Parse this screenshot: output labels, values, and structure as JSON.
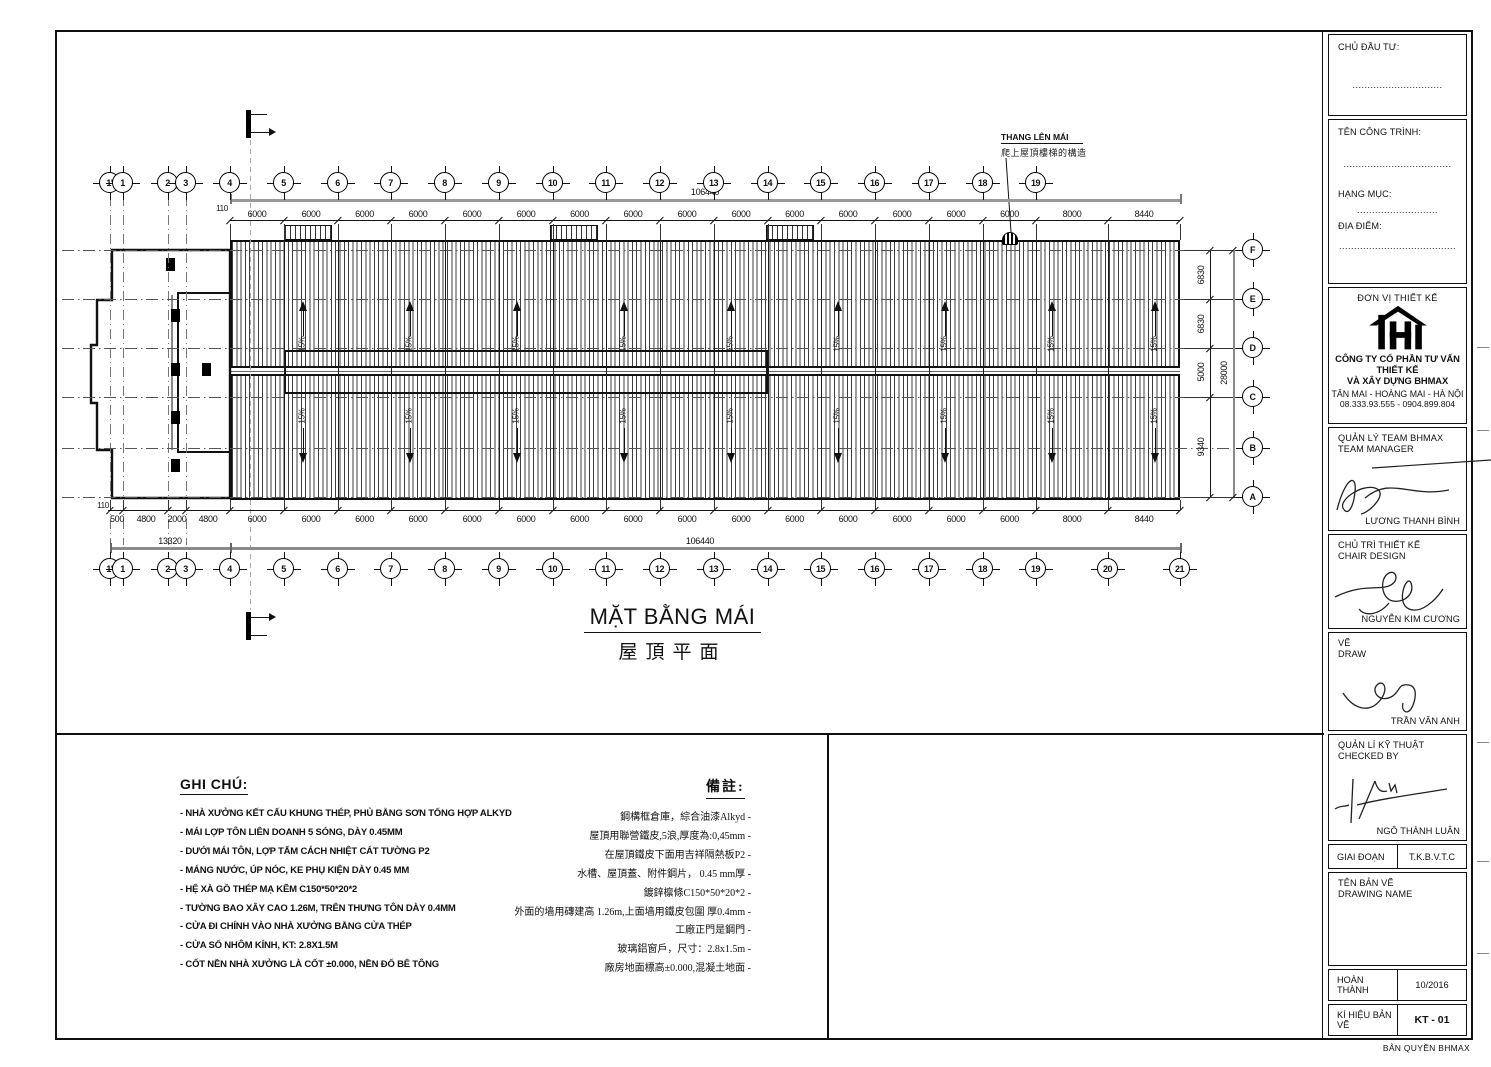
{
  "plan": {
    "title_vi": "MẶT BẰNG MÁI",
    "title_cn": "屋頂平面",
    "ladder_label_vi": "THANG LÊN MÁI",
    "ladder_label_cn": "爬上屋頂樓梯的構造",
    "slope_label": "15%",
    "grids": {
      "top": [
        "1'",
        "1",
        "2",
        "3",
        "4",
        "5",
        "6",
        "7",
        "8",
        "9",
        "10",
        "11",
        "12",
        "13",
        "14",
        "15",
        "16",
        "17",
        "18",
        "19"
      ],
      "bottom": [
        "1'",
        "1",
        "2",
        "3",
        "4",
        "5",
        "6",
        "7",
        "8",
        "9",
        "10",
        "11",
        "12",
        "13",
        "14",
        "15",
        "16",
        "17",
        "18",
        "19",
        "20",
        "21"
      ],
      "letters": [
        "F",
        "E",
        "D",
        "C",
        "B",
        "A"
      ]
    },
    "dims": {
      "top": [
        "110",
        "6000",
        "6000",
        "6000",
        "6000",
        "6000",
        "6000",
        "6000",
        "6000",
        "6000",
        "6000",
        "6000",
        "6000",
        "6000",
        "6000",
        "6000",
        "8000",
        "8440"
      ],
      "top_total": "106440",
      "bottom": [
        "6000",
        "6000",
        "6000",
        "6000",
        "6000",
        "6000",
        "6000",
        "6000",
        "6000",
        "6000",
        "6000",
        "6000",
        "6000",
        "6000",
        "6000",
        "8000",
        "8440"
      ],
      "bottom_left": [
        "110",
        "500",
        "4800",
        "2000",
        "4800"
      ],
      "bottom_subtotal": "13320",
      "bottom_total": "106440",
      "right": [
        "6830",
        "6830",
        "5000",
        "9340"
      ],
      "right_total": "28000"
    }
  },
  "notes_vi": {
    "title": "GHI CHÚ:",
    "items": [
      "NHÀ XƯỞNG KẾT CẤU KHUNG THÉP, PHỦ BẰNG SƠN TỔNG HỢP ALKYD",
      "MÁI LỢP TÔN LIÊN DOANH 5 SÓNG, DÀY 0.45MM",
      "DƯỚI MÁI TÔN, LỢP TẤM CÁCH NHIỆT CÁT TƯỜNG P2",
      "MÁNG NƯỚC, ÚP NÓC, KE PHỤ KIỆN DÀY 0.45 MM",
      "HỆ XÀ GỒ THÉP MẠ KẼM C150*50*20*2",
      "TƯỜNG BAO XÂY CAO 1.26M, TRÊN THƯNG TÔN DÀY 0.4MM",
      "CỬA ĐI CHÍNH VÀO NHÀ XƯỞNG BẰNG CỬA THÉP",
      "CỬA SỔ NHÔM KÍNH, KT: 2.8X1.5M",
      "CỐT NỀN NHÀ XƯỞNG LÀ CỐT ±0.000, NỀN ĐỔ BÊ TÔNG"
    ]
  },
  "notes_cn": {
    "title": "備註:",
    "items": [
      "鋼構框倉庫，綜合油漆Alkyd",
      "屋頂用聯營鐵皮,5浪,厚度為:0,45mm",
      "在屋頂鐵皮下面用吉祥隔熱板P2",
      "水槽、屋頂蓋、附件鋼片， 0.45 mm厚",
      "鍍鋅檩條C150*50*20*2",
      "外面的墙用磚建高 1.26m,上面墙用鐵皮包圍 厚0.4mm",
      "工廠正門是鋼門",
      "玻璃鋁窗戶，尺寸：2.8x1.5m",
      "廠房地面標高±0.000,混凝土地面"
    ]
  },
  "title_block": {
    "client_label": "CHỦ ĐẦU TƯ:",
    "client_dots": "..............................",
    "project_label": "TÊN CÔNG TRÌNH:",
    "project_dots": "....................................",
    "item_label": "HẠNG MỤC:",
    "item_dots": "...........................",
    "location_label": "ĐỊA ĐIỂM:",
    "location_dots": ".......................................",
    "designer_label": "ĐƠN VỊ THIẾT KẾ",
    "company_line1": "CÔNG TY CỔ PHẦN TƯ VẤN THIẾT KẾ",
    "company_line2": "VÀ XÂY DỰNG BHMAX",
    "address": "TÂN MAI - HOÀNG MAI - HÀ NỘI",
    "phone": "08.333.93.555 - 0904.899.804",
    "roles": [
      {
        "label1": "QUẢN LÝ TEAM BHMAX",
        "label2": "TEAM MANAGER",
        "name": "LƯƠNG THANH BÌNH"
      },
      {
        "label1": "CHỦ TRÌ THIẾT KẾ",
        "label2": "CHAIR DESIGN",
        "name": "NGUYỄN KIM CƯƠNG"
      },
      {
        "label1": "VẼ",
        "label2": "DRAW",
        "name": "TRẦN VĂN ANH"
      },
      {
        "label1": "QUẢN LÍ KỸ THUẬT",
        "label2": "CHECKED BY",
        "name": "NGÔ THÀNH LUÂN"
      }
    ],
    "stage_label": "GIAI ĐOẠN",
    "stage_value": "T.K.B.V.T.C",
    "drawing_name_label1": "TÊN BẢN VẼ",
    "drawing_name_label2": "DRAWING NAME",
    "completed_label": "HOÀN THÀNH",
    "completed_value": "10/2016",
    "code_label": "KÍ HIỆU BẢN VẼ",
    "code_value": "KT - 01"
  },
  "footer": {
    "copyright": "BẢN QUYỀN BHMAX"
  }
}
